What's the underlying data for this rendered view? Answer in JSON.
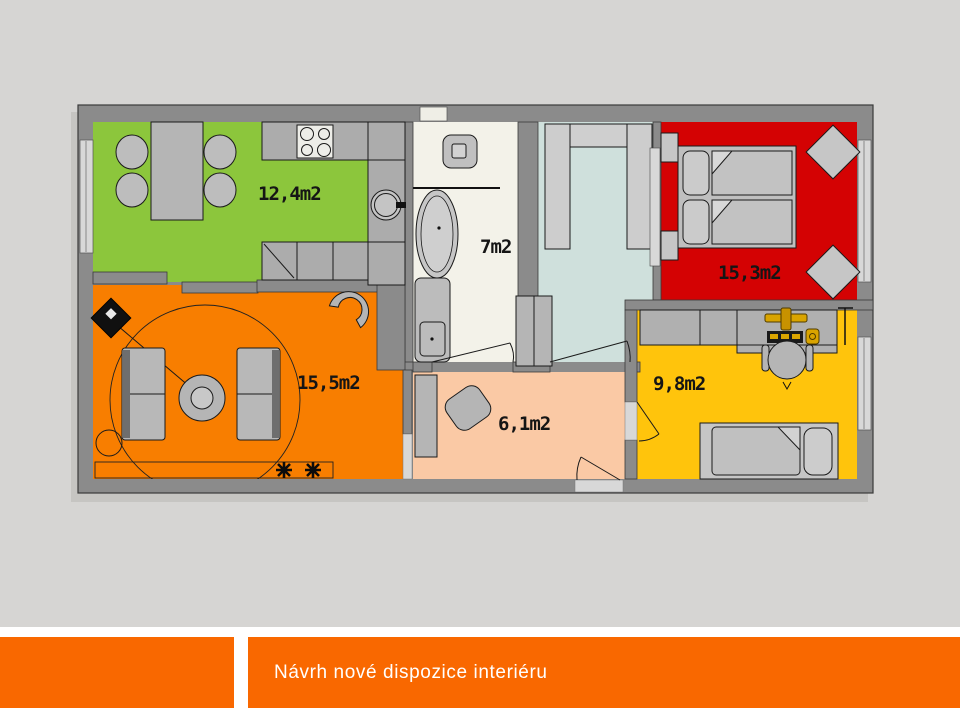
{
  "slide": {
    "title": "Návrh nové dispozice interiéru",
    "background_color": "#D6D5D3",
    "banner_color": "#F96800",
    "title_color": "#FFFFFF"
  },
  "plan": {
    "wall_color": "#8B8B8B",
    "furniture_color": "#BDBDBD",
    "rooms": {
      "kitchen_dining": {
        "area_label": "12,4m2",
        "color": "#8CC63C"
      },
      "living_room": {
        "area_label": "15,5m2",
        "color": "#F87E00"
      },
      "bathroom": {
        "area_label": "7m2",
        "color": "#F3F2E9"
      },
      "bedroom": {
        "area_label": "15,3m2",
        "color": "#D40203"
      },
      "study_room": {
        "area_label": "9,8m2",
        "color": "#FFC40C"
      },
      "hallway": {
        "area_label": "6,1m2",
        "color": "#FAC9A5"
      },
      "hall_closet": {
        "color": "#CFE0DC"
      }
    }
  }
}
